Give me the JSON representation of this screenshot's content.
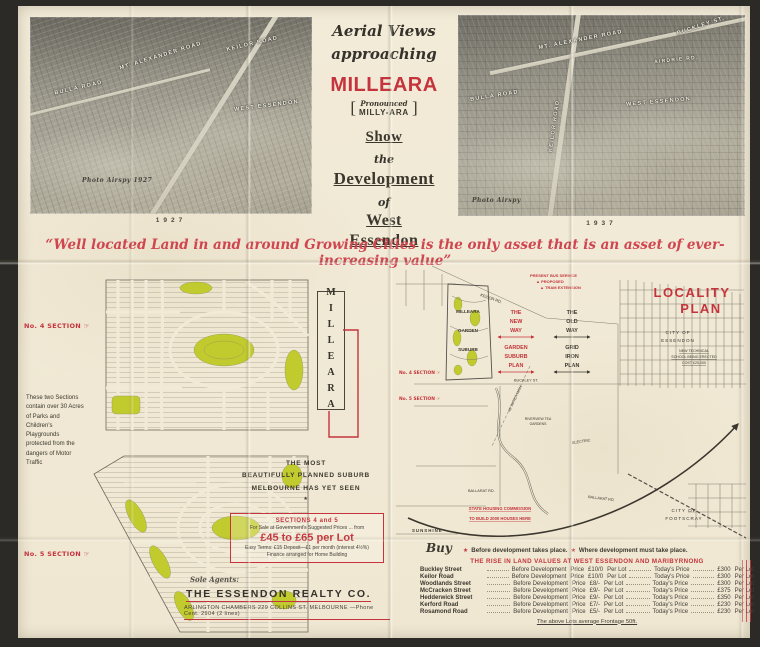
{
  "palette": {
    "paper": "#f1ead6",
    "red": "#c5343c",
    "green": "#c2cb2d",
    "ink": "#3b372e"
  },
  "header": {
    "center": {
      "script_line1": "Aerial Views",
      "script_line2": "approaching",
      "title": "MILLEARA",
      "bracket_open": "[",
      "pronounced_word": "Pronounced",
      "pronounced_name": "MILLY-ARA",
      "bracket_close": "]",
      "show": "Show",
      "the": "the",
      "development": "Development",
      "of": "of",
      "west": "West",
      "essendon": "Essendon"
    },
    "left_photo": {
      "year": "1927",
      "credit": "Photo Airspy 1927",
      "labels": [
        "MT. ALEXANDER ROAD",
        "BULLA ROAD",
        "KEILOR ROAD",
        "WEST ESSENDON"
      ]
    },
    "right_photo": {
      "year": "1937",
      "credit": "Photo Airspy",
      "labels": [
        "MT. ALEXANDER ROAD",
        "BUCKLEY ST.",
        "BULLA ROAD",
        "KEILOR ROAD",
        "WEST ESSENDON",
        "AIRDRIE RD."
      ]
    }
  },
  "quote": "“Well located Land in and around Growing Cities is the only asset that is an asset of ever-increasing value”",
  "estate_plan": {
    "section4_label": "No. 4 SECTION ☞",
    "section5_label": "No. 5 SECTION ☞",
    "side_note": "These two Sections contain over 30 Acres of Parks and Children's Playgrounds protected from the dangers of Motor Traffic",
    "vertical_title": "MILLEARA",
    "tagline_line1": "THE MOST",
    "tagline_line2": "BEAUTIFULLY PLANNED SUBURB",
    "tagline_line3": "MELBOURNE HAS YET SEEN",
    "tagline_star": "★",
    "offer_box": {
      "heading": "SECTIONS 4 and 5",
      "subline": "For Sale at Government's Suggested Prices  ...  from",
      "price": "£45 to £65 per Lot",
      "terms": "Easy Terms: £15 Deposit—£1 per month (interest 4½%)",
      "finance": "Finance arranged for Home Building"
    },
    "agents": {
      "sole": "Sole Agents:",
      "name": "THE ESSENDON REALTY CO.",
      "address": "ARLINGTON CHAMBERS 229 COLLINS ST. MELBOURNE —Phone Cent. 2904 (2 lines)"
    }
  },
  "locality_plan": {
    "title_line1": "LOCALITY",
    "title_line2": "PLAN",
    "legend": [
      "PRESENT BUS SERVICE",
      "▲ PROPOSED",
      "▲ TRAM EXTENSION"
    ],
    "new_way": [
      "THE",
      "NEW",
      "WAY"
    ],
    "garden_plan": [
      "GARDEN",
      "SUBURB",
      "PLAN"
    ],
    "old_way": [
      "THE",
      "OLD",
      "WAY"
    ],
    "grid_plan": [
      "GRID",
      "IRON",
      "PLAN"
    ],
    "estate_labels": [
      "MILLEARA",
      "GARDEN",
      "SUBURB"
    ],
    "section4_label": "No. 4 SECTION ☞",
    "section5_label": "No. 5 SECTION ☞",
    "city_essendon": [
      "CITY OF",
      "ESSENDON"
    ],
    "city_footscray": [
      "CITY OF",
      "FOOTSCRAY"
    ],
    "tech_school": [
      "NEW TECHNICAL",
      "SCHOOL BEING ERECTED",
      "COST £25,000"
    ],
    "tea_gardens": [
      "RIVERVIEW TEA",
      "GARDENS"
    ],
    "electric": "ELECTRIC",
    "water_main": "40' WATER MAIN",
    "keilor_rd": "KEILOR RD.",
    "buckley_st": "BUCKLEY ST.",
    "ballarat_rd": "BALLARAT RD.",
    "housing": [
      "STATE HOUSING COMMISSION",
      "TO BUILD 2000 HOUSES HERE"
    ],
    "sunshine": "SUNSHINE"
  },
  "values_table": {
    "buy_label": "Buy",
    "star": "★",
    "legend_before": "Before development takes place.",
    "legend_where": "Where development must take place.",
    "heading": "THE RISE IN LAND VALUES AT WEST ESSENDON AND MARIBYRNONG",
    "col_before": "Before Development",
    "col_price": "Price",
    "col_per": "Per Lot",
    "col_today": "Today's Price",
    "rows": [
      {
        "street": "Buckley Street",
        "before": "£10/0",
        "today": "£300"
      },
      {
        "street": "Keilor Road",
        "before": "£10/0",
        "today": "£300"
      },
      {
        "street": "Woodlands Street",
        "before": "£8/-",
        "today": "£300"
      },
      {
        "street": "McCracken Street",
        "before": "£9/-",
        "today": "£375"
      },
      {
        "street": "Hedderwick Street",
        "before": "£9/-",
        "today": "£350"
      },
      {
        "street": "Kerford Road",
        "before": "£7/-",
        "today": "£230"
      },
      {
        "street": "Rosamond Road",
        "before": "£5/-",
        "today": "£230"
      }
    ],
    "footer": "The above Lots average Frontage 50ft."
  }
}
